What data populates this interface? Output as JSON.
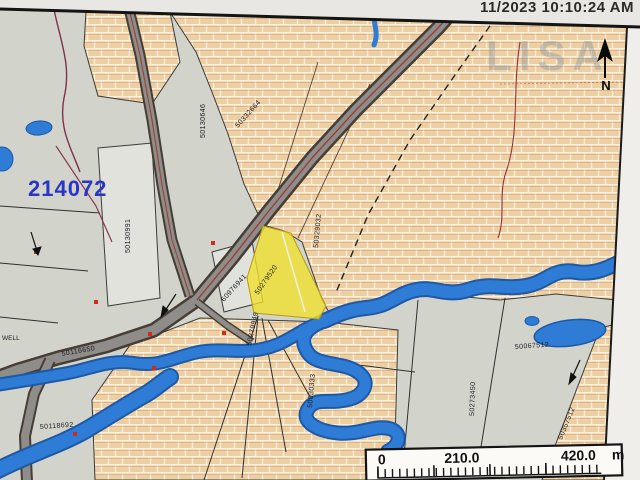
{
  "header": {
    "timestamp": "11/2023 10:10:24 AM"
  },
  "watermark": {
    "text": "LISA"
  },
  "compass": {
    "north_label": "N"
  },
  "map": {
    "highlight_pid": "214072",
    "well_label": "WELL",
    "parcel_labels": [
      {
        "text": "50130991"
      },
      {
        "text": "50130646"
      },
      {
        "text": "50332664"
      },
      {
        "text": "50329032"
      },
      {
        "text": "50279520"
      },
      {
        "text": "60976941"
      },
      {
        "text": "50279949"
      },
      {
        "text": "50030333"
      },
      {
        "text": "50116650"
      },
      {
        "text": "50118692"
      },
      {
        "text": "50067512"
      },
      {
        "text": "50273450"
      },
      {
        "text": "50357512"
      }
    ]
  },
  "scalebar": {
    "start": "0",
    "mid": "210.0",
    "end": "420.0",
    "unit": "m"
  },
  "colors": {
    "water": "#2e7cd6",
    "water_edge": "#1d59a6",
    "brick_fill": "#eccfa2",
    "road": "#8f8d89",
    "road_edge": "#463d35",
    "highlight_parcel": "#f0e02e",
    "pid_text": "#2a35c8",
    "map_background": "#d2d4cc"
  }
}
